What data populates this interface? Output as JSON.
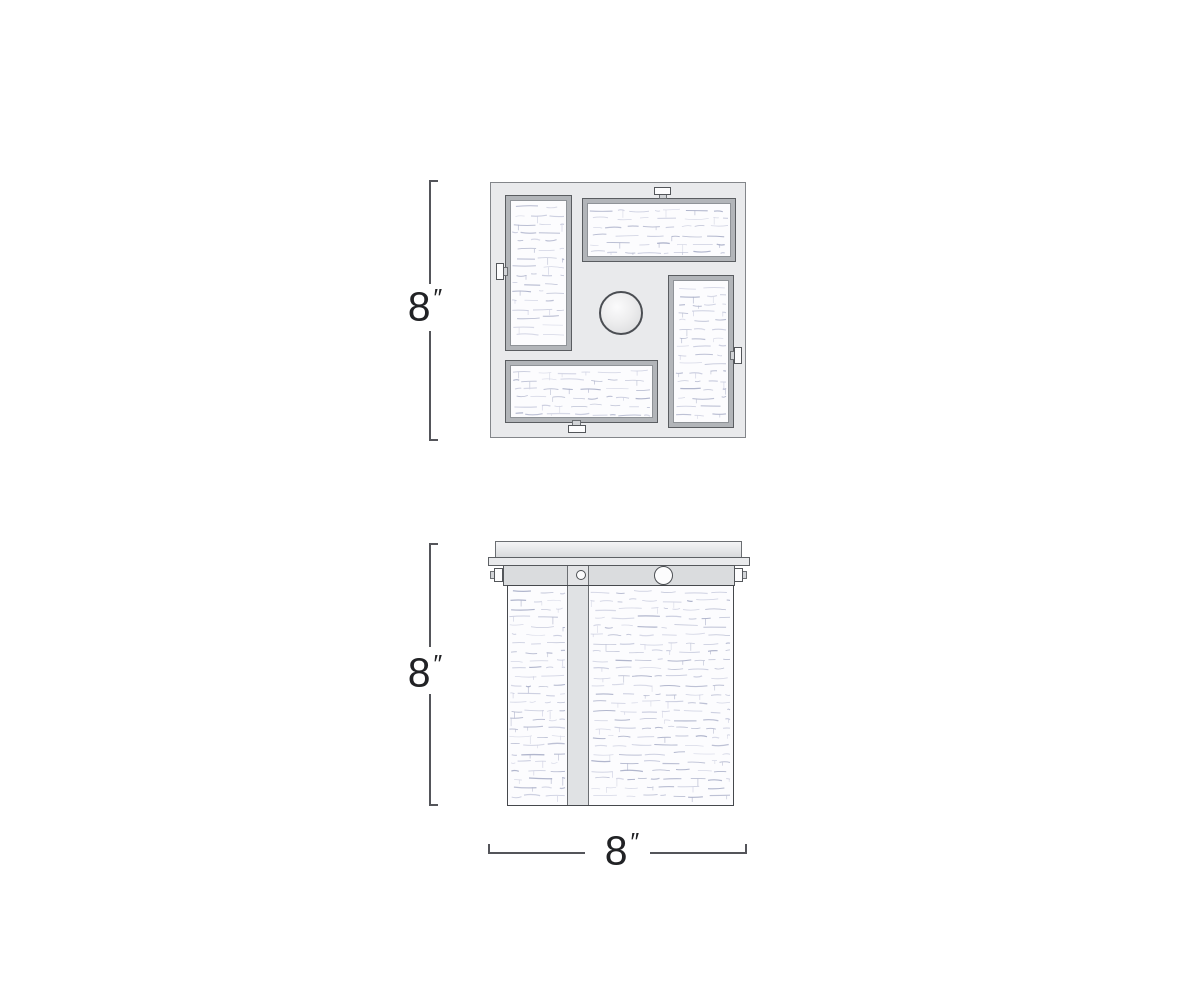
{
  "drawing": {
    "dimensions": {
      "top_view_height": {
        "value": "8",
        "unit": "″"
      },
      "side_view_height": {
        "value": "8",
        "unit": "″"
      },
      "side_view_width": {
        "value": "8",
        "unit": "″"
      }
    },
    "colors": {
      "plate_fill": "#e9eaec",
      "frame_fill": "#b2b5b9",
      "glass_fill": "#fcfcfe",
      "glass_texture": [
        "#b6bad0",
        "#c8cbde",
        "#a9aec8",
        "#d3d5e4"
      ],
      "metal_fill": "#dcdee0",
      "line": "#54555a",
      "text": "#212225"
    }
  }
}
